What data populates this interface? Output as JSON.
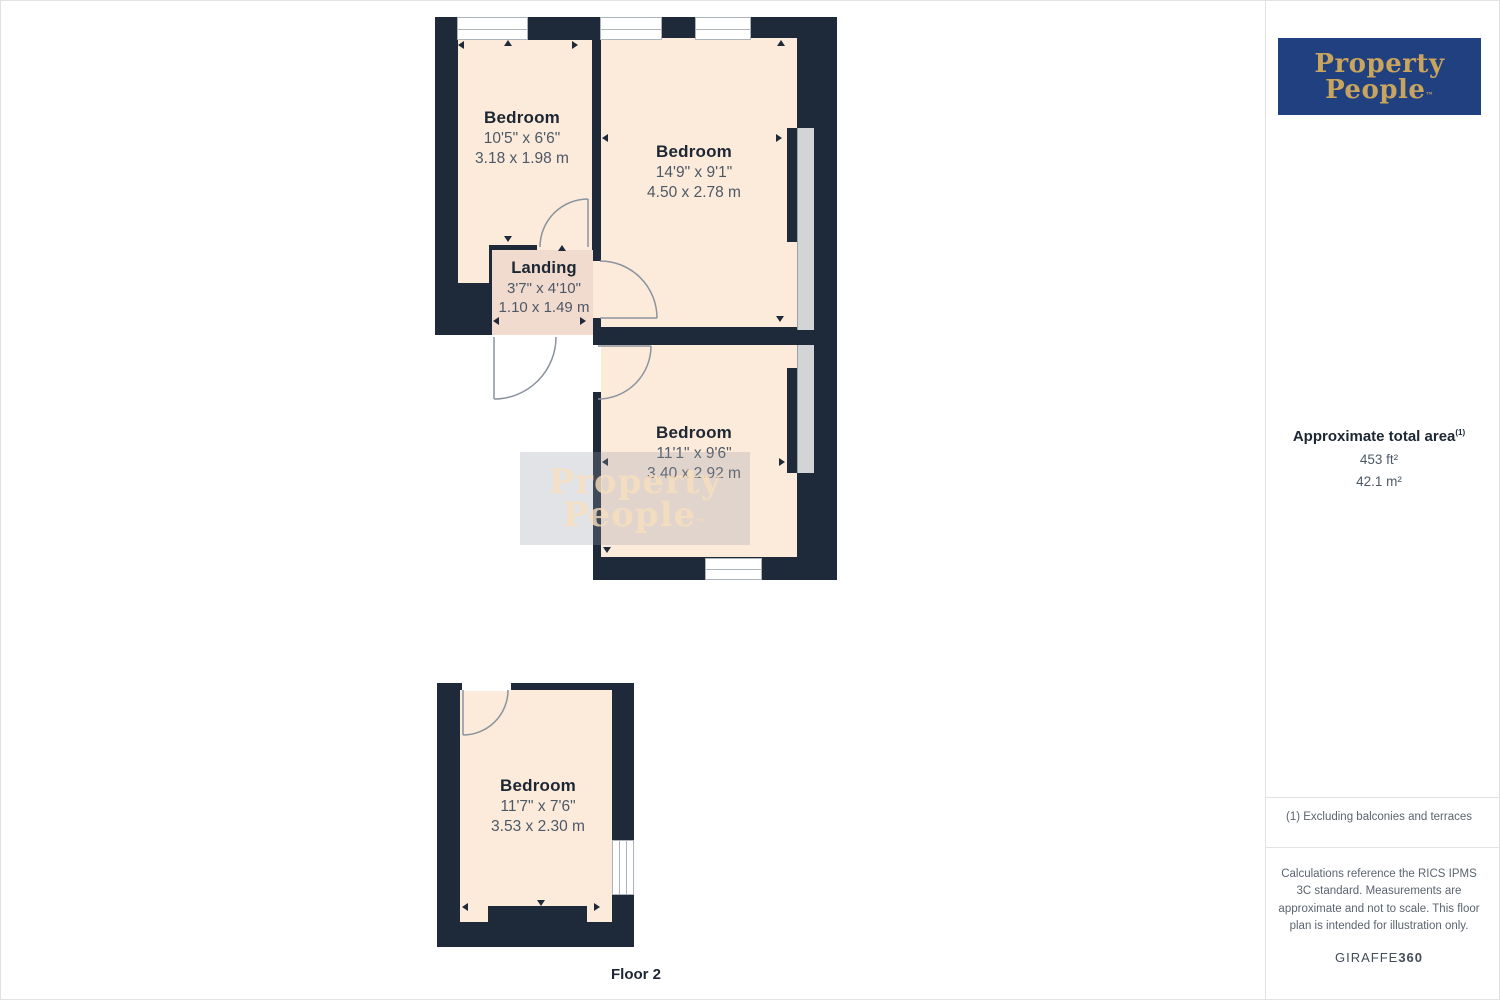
{
  "branding": {
    "logo_line1": "Property",
    "logo_line2": "People",
    "tm": "™",
    "logo_bg_color": "#20407f",
    "logo_text_color": "#c8a45d"
  },
  "watermark": {
    "line1": "Property",
    "line2": "People",
    "tm": "™"
  },
  "floorplan": {
    "floor_label": "Floor 2",
    "colors": {
      "wall": "#1e2a39",
      "room_fill": "#fcebdb",
      "landing_fill": "#f1dbce",
      "window_glass": "#d2d4d6"
    },
    "rooms": {
      "top_left": {
        "name": "Bedroom",
        "imperial": "10'5\" x 6'6\"",
        "metric": "3.18 x 1.98 m"
      },
      "top_right": {
        "name": "Bedroom",
        "imperial": "14'9\" x 9'1\"",
        "metric": "4.50 x 2.78 m"
      },
      "landing": {
        "name": "Landing",
        "imperial": "3'7\" x 4'10\"",
        "metric": "1.10 x 1.49 m"
      },
      "middle": {
        "name": "Bedroom",
        "imperial": "11'1\" x 9'6\"",
        "metric": "3.40 x 2.92 m"
      },
      "floor2_bedroom": {
        "name": "Bedroom",
        "imperial": "11'7\" x 7'6\"",
        "metric": "3.53 x 2.30 m"
      }
    }
  },
  "sidebar": {
    "area_title": "Approximate total area",
    "area_title_sup": "(1)",
    "area_ft": "453 ft²",
    "area_m": "42.1 m²",
    "note1": "(1) Excluding balconies and terraces",
    "note2": "Calculations reference the RICS IPMS 3C standard. Measurements are approximate and not to scale. This floor plan is intended for illustration only.",
    "brand_footer_regular": "GIRAFFE",
    "brand_footer_bold": "360"
  }
}
